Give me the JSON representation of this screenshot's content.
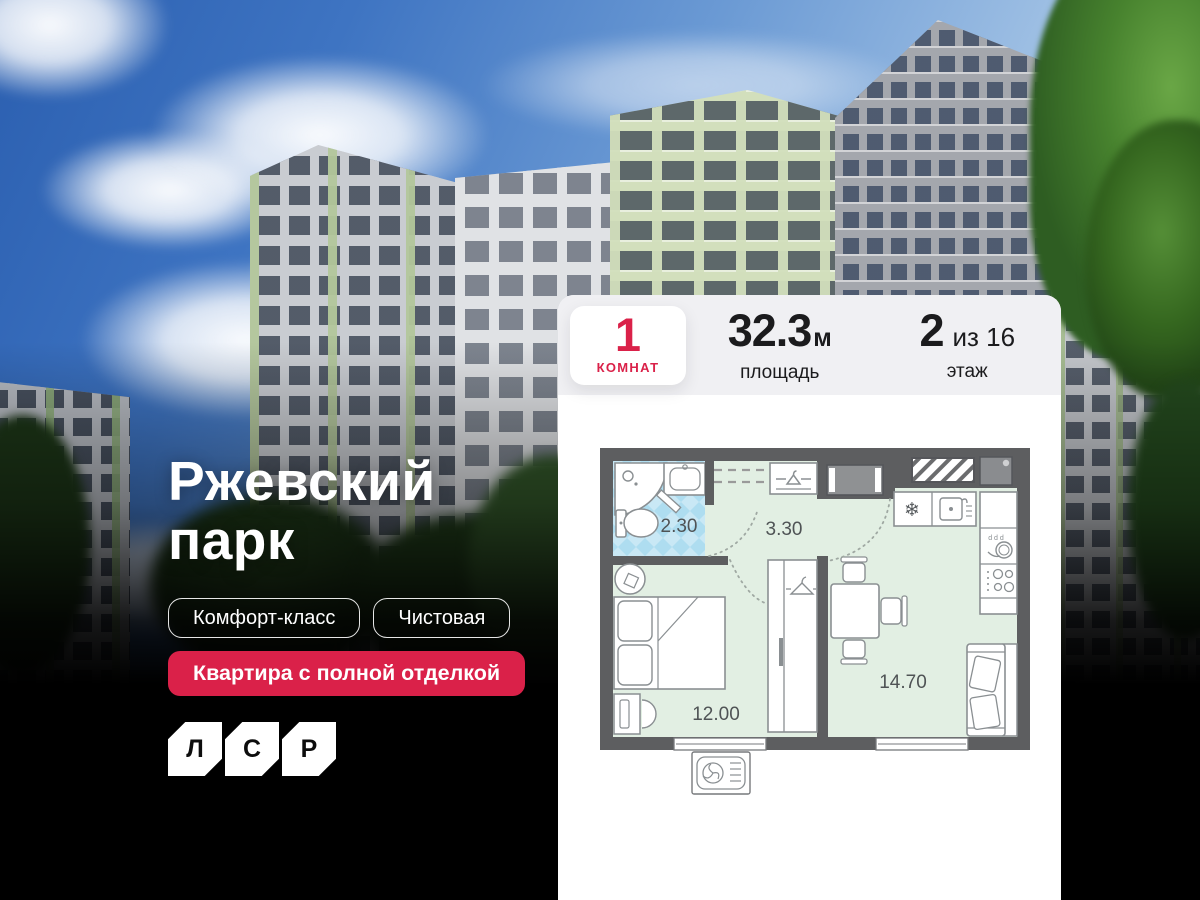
{
  "hero": {
    "title_line1": "Ржевский",
    "title_line2": "парк",
    "badges": [
      "Комфорт-класс",
      "Чистовая"
    ],
    "highlight_badge": "Квартира с полной отделкой",
    "logo_letters": [
      "Л",
      "С",
      "Р"
    ]
  },
  "info": {
    "rooms": {
      "value": "1",
      "label": "КОМНАТ"
    },
    "area": {
      "value": "32.3",
      "unit": "м",
      "label": "площадь"
    },
    "floor": {
      "value": "2",
      "of": "из 16",
      "label": "этаж"
    }
  },
  "plan": {
    "areas": {
      "bathroom": "2.30",
      "hallway": "3.30",
      "bedroom": "12.00",
      "living": "14.70"
    }
  },
  "icons": {
    "snowflake": "❄"
  },
  "colors": {
    "accent_red": "#da2149",
    "plan_wall": "#5d5e60",
    "plan_room_fill": "#e2efe3",
    "plan_bath_fill": "#c9e8f5",
    "card_header_bg": "#f0f0f3",
    "sky_blue": "#3e74c2"
  }
}
